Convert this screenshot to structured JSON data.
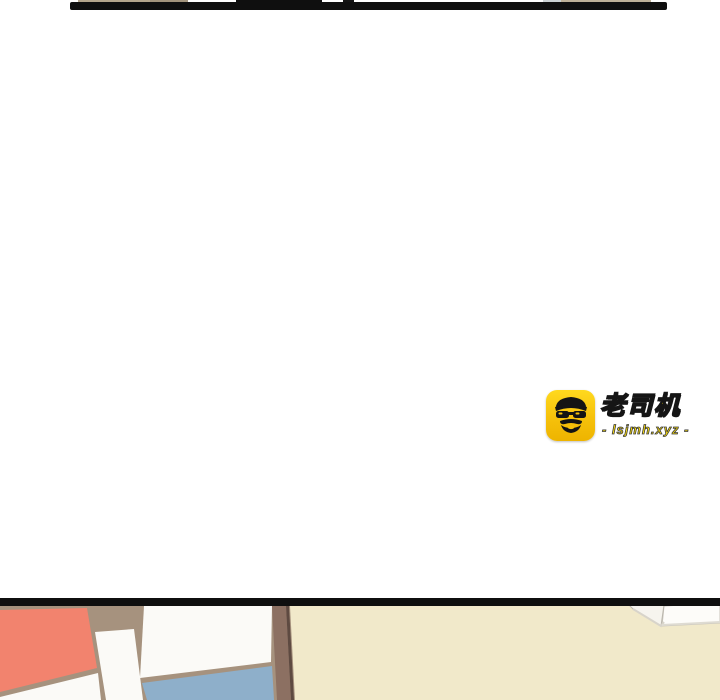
{
  "page": {
    "kind": "comic-reader-scroll-view",
    "background_color": "#ffffff"
  },
  "top_panel_edge": {
    "description": "bottom border of previous comic panel",
    "bar_color": "#0f0f0f",
    "artwork_colors": [
      "#b3a58c",
      "#a2937c",
      "#bdb098",
      "#ccd2d4"
    ]
  },
  "watermark": {
    "site_name": "老司机",
    "site_url": "- lsjmh.xyz -",
    "icon": "driver-avatar-icon",
    "icon_bg_color": "#f6c10b",
    "icon_figure_color": "#141414",
    "text_color": "#ffe10a",
    "outline_color": "#151515"
  },
  "bottom_panel": {
    "description": "top edge of next comic panel: interior wall with Mondrian-style window",
    "divider_color": "#0f0f0f",
    "wall_color": "#f1e9ca",
    "frame_color": "#a6927e",
    "frame_dark_color": "#8c7062",
    "frame_edge_color": "#5e4a41",
    "pane_salmon_color": "#f2836e",
    "pane_white_color": "#fbfaf7",
    "pane_blue_color": "#8eafca",
    "rod_color": "#f6f4ee"
  }
}
